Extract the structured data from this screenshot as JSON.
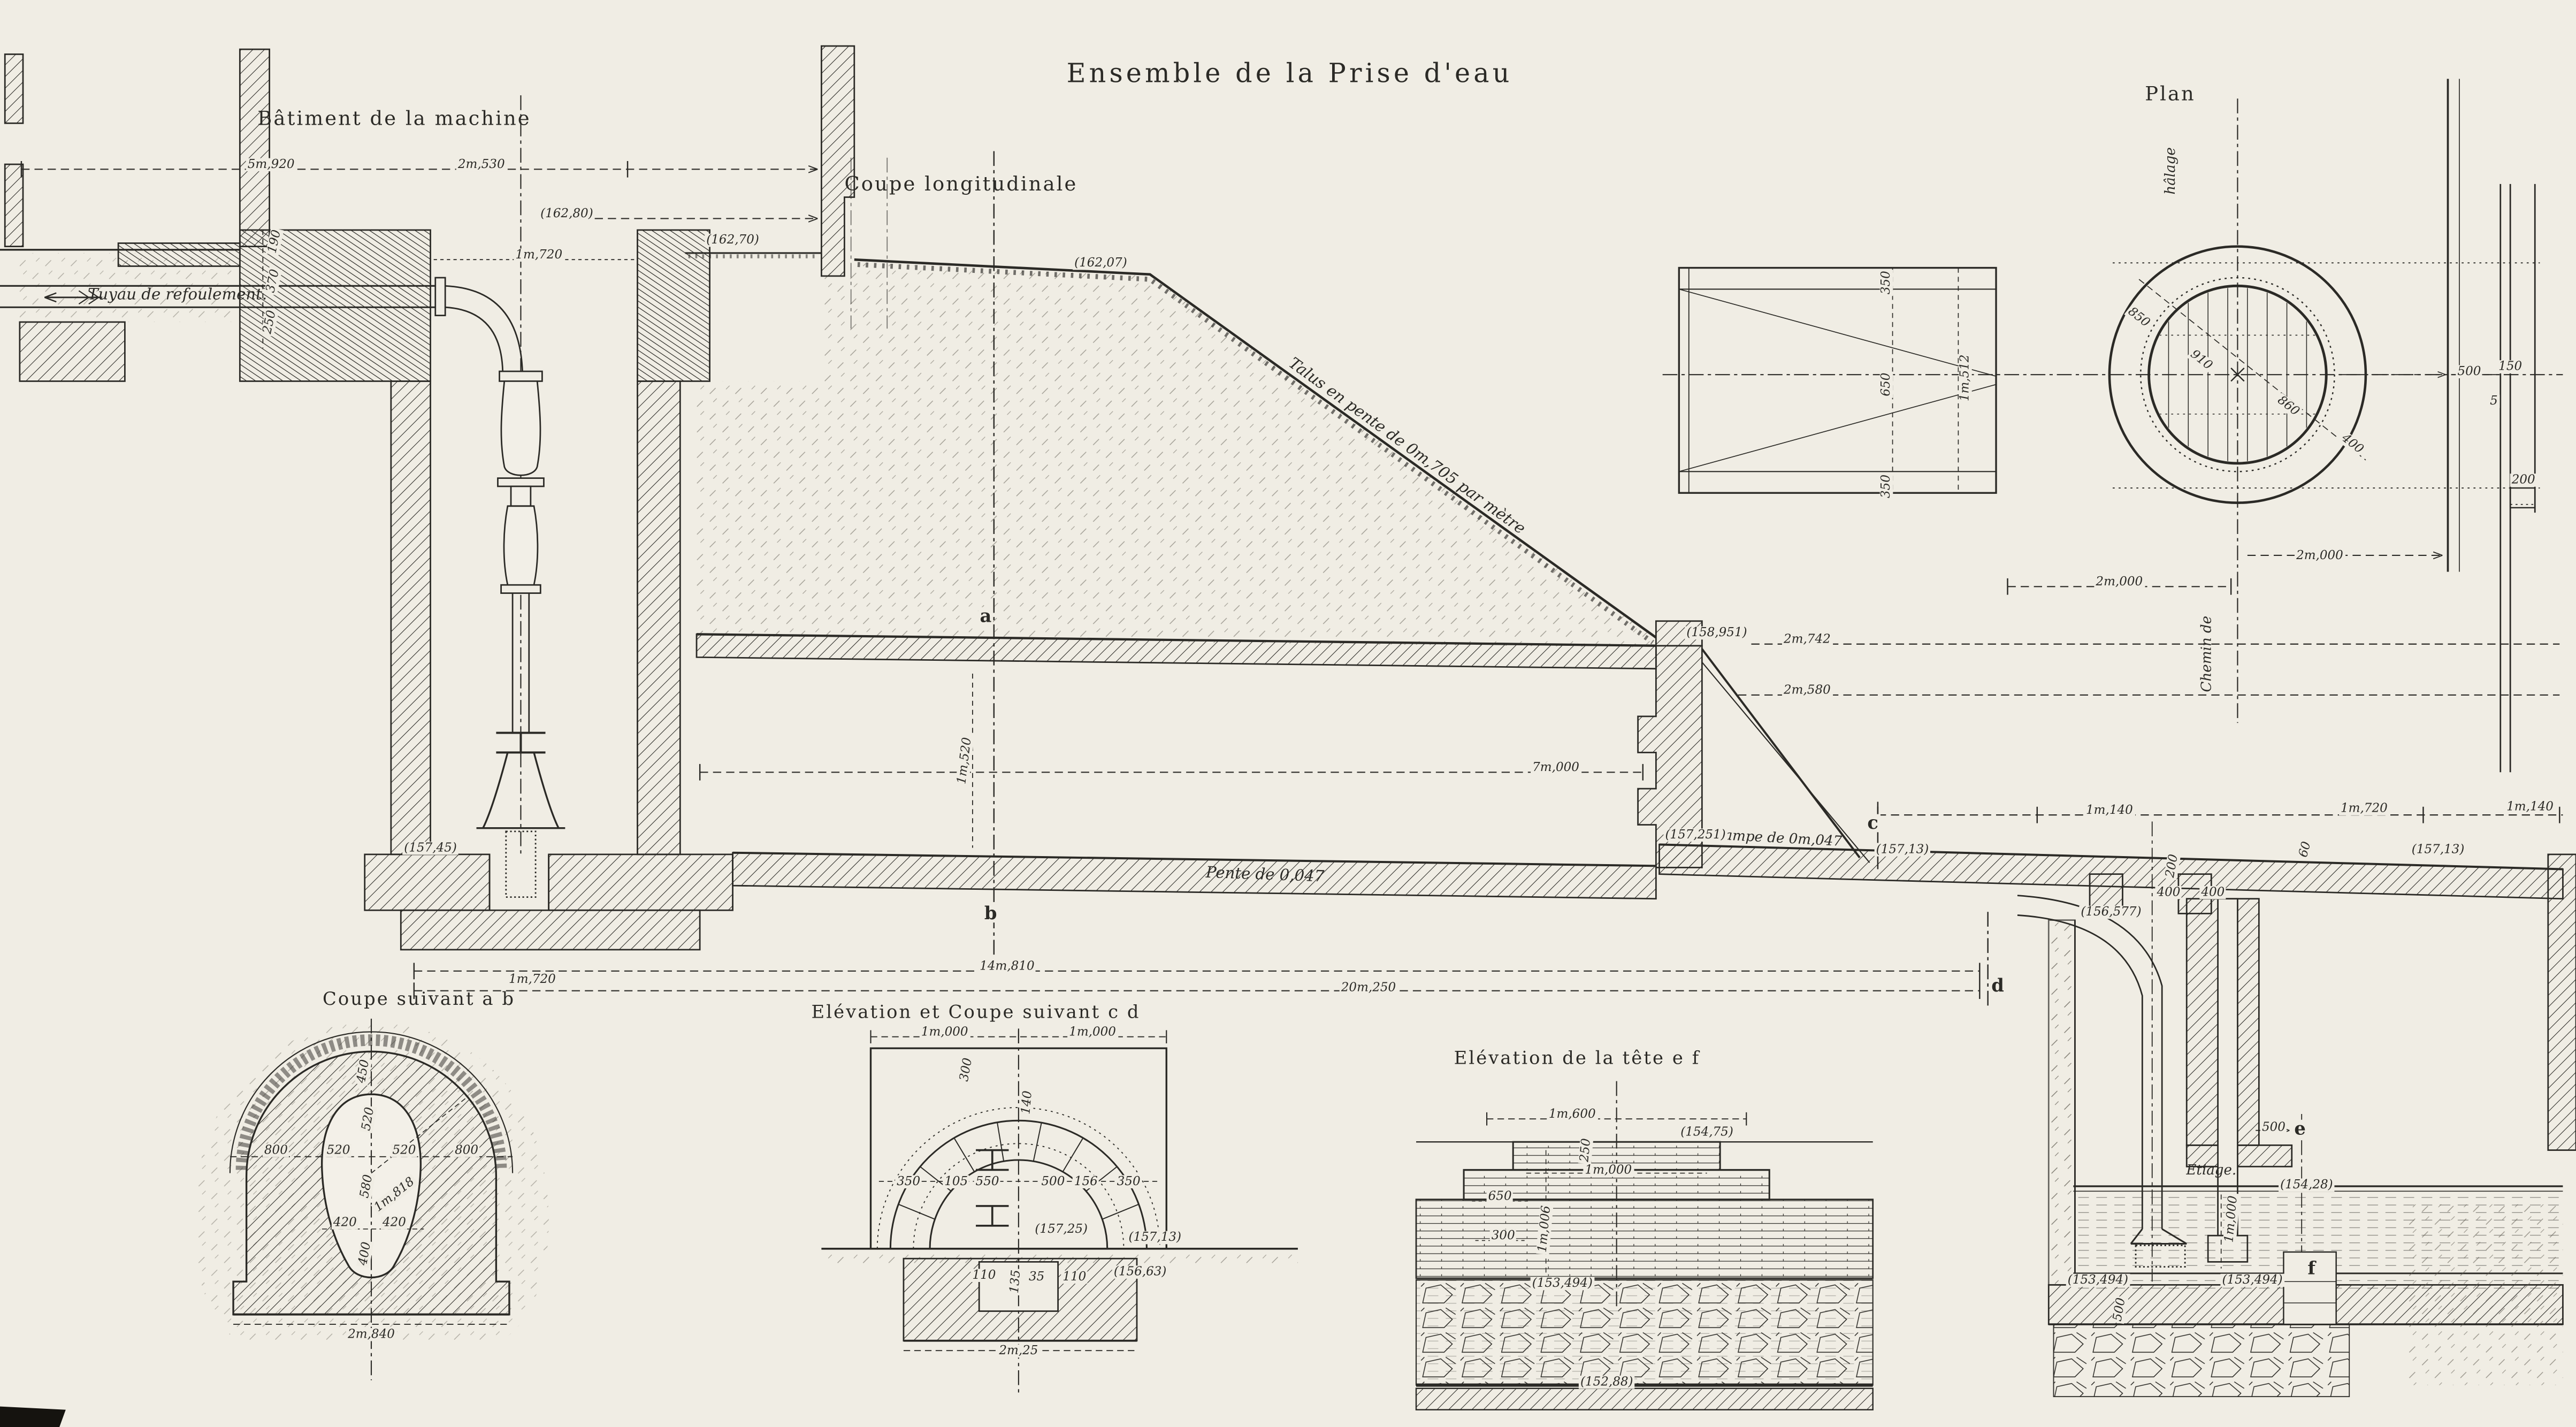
{
  "titles": {
    "main": "Ensemble de la Prise d'eau",
    "machine": "Bâtiment de la machine",
    "longitudinal": "Coupe longitudinale",
    "plan": "Plan",
    "ab": "Coupe suivant a b",
    "cd": "Elévation et Coupe suivant c d",
    "ef": "Elévation de la tête e f"
  },
  "notes": {
    "tuyau": "Tuyau de refoulement.",
    "talus": "Talus en pente de 0m,705 par mètre",
    "rampe": "Rampe de 0m,047",
    "pente": "Pente de 0,047",
    "etiage": "Etiage.",
    "chemin_de": "Chemin de",
    "halage": "hâlage"
  },
  "markers": {
    "a": "a",
    "b": "b",
    "c": "c",
    "d": "d",
    "e": "e",
    "f": "f"
  },
  "levels": {
    "v16280": "(162,80)",
    "v16270": "(162,70)",
    "v16207": "(162,07)",
    "v158951": "(158,951)",
    "v157251": "(157,251)",
    "v15713": "(157,13)",
    "v15745": "(157,45)",
    "v156577": "(156,577)",
    "v15725": "(157,25)",
    "v15663": "(156,63)",
    "v15475": "(154,75)",
    "v15428": "(154,28)",
    "v153494": "(153,494)",
    "v15288": "(152,88)"
  },
  "dims": {
    "d5920": "5m,920",
    "d2530": "2m,530",
    "d1720": "1m,720",
    "d190": "190",
    "d370": "370",
    "d250": "250",
    "d2742": "2m,742",
    "d2580": "2m,580",
    "d7000": "7m,000",
    "d1520": "1m,520",
    "d14810": "14m,810",
    "d20250": "20m,250",
    "d1140": "1m,140",
    "d400": "400",
    "d200": "200",
    "d60": "60",
    "d450": "450",
    "d520": "520",
    "d800": "800",
    "d580": "580",
    "d1818": "1m,818",
    "d420": "420",
    "d2840": "2m,840",
    "d1000": "1m,000",
    "d140": "140",
    "d300": "300",
    "d350": "350",
    "d105": "105",
    "d550": "550",
    "d500": "500",
    "d156": "156",
    "d650": "650",
    "d35": "35",
    "d135": "135",
    "d110": "110",
    "d225": "2m,25",
    "d1600": "1m,600",
    "d1006": "1m,006",
    "d1512": "1m,512",
    "d850": "850",
    "d910": "910",
    "d860": "860",
    "d150": "150",
    "d5": "5",
    "d2000": "2m,000"
  }
}
